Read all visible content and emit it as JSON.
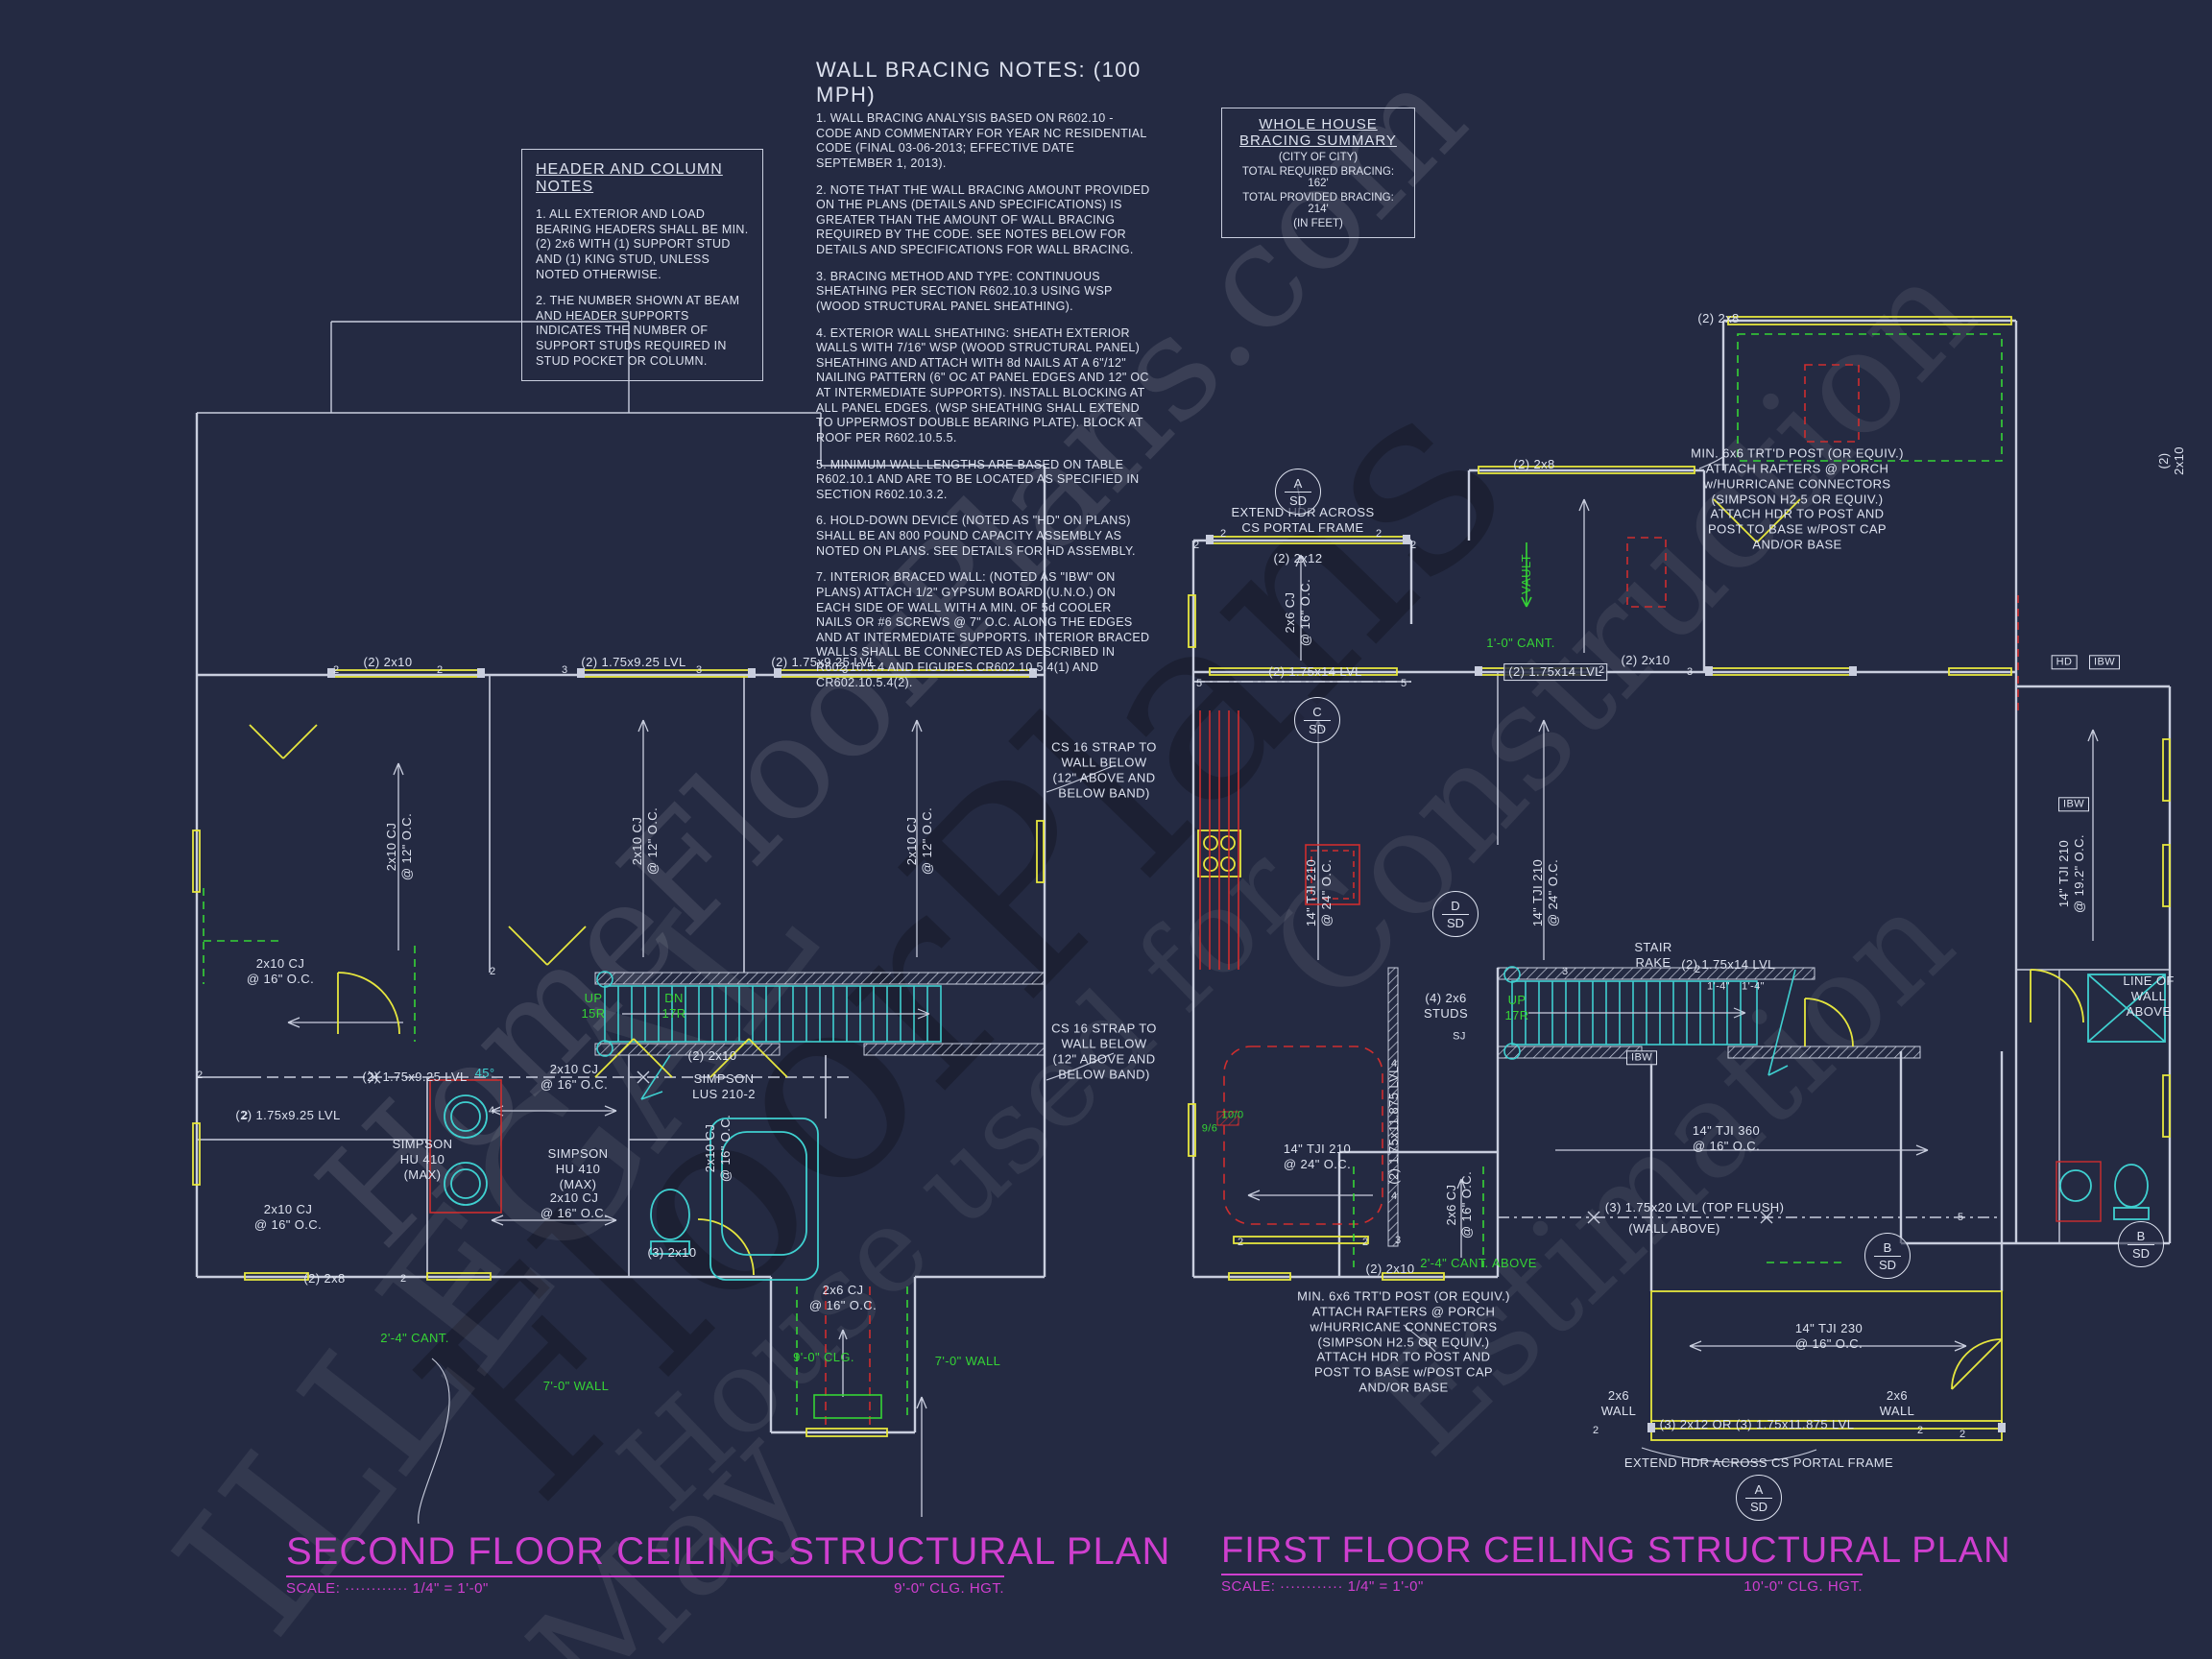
{
  "sheet": {
    "background": "#242a42"
  },
  "colors": {
    "line": "#c9cede",
    "yellow": "#e6e63e",
    "cyan": "#3fd0d0",
    "red": "#cf2e2e",
    "green": "#35d435",
    "magenta": "#cf3fcf",
    "text": "#dde2ef"
  },
  "watermark": {
    "pieces": [
      "ILLEGAL",
      "HomeFloorPlans.com",
      "May",
      "House used for",
      "Construction",
      "Estimation",
      "FloorPlans"
    ]
  },
  "notes": {
    "header_column": {
      "title": "HEADER AND COLUMN NOTES",
      "items": [
        "1. ALL EXTERIOR AND LOAD BEARING HEADERS SHALL BE MIN. (2) 2x6 WITH (1) SUPPORT STUD AND (1) KING STUD, UNLESS NOTED OTHERWISE.",
        "2. THE NUMBER SHOWN AT BEAM AND HEADER SUPPORTS INDICATES THE NUMBER OF SUPPORT STUDS REQUIRED IN STUD POCKET OR COLUMN."
      ]
    },
    "wall_bracing": {
      "title": "WALL BRACING NOTES: (100 MPH)",
      "items": [
        "1. WALL BRACING ANALYSIS BASED ON R602.10 - CODE AND COMMENTARY FOR YEAR NC RESIDENTIAL CODE (FINAL 03-06-2013; EFFECTIVE DATE SEPTEMBER 1, 2013).",
        "2. NOTE THAT THE WALL BRACING AMOUNT PROVIDED ON THE PLANS (DETAILS AND SPECIFICATIONS) IS GREATER THAN THE AMOUNT OF WALL BRACING REQUIRED BY THE CODE. SEE NOTES BELOW FOR DETAILS AND SPECIFICATIONS FOR WALL BRACING.",
        "3. BRACING METHOD AND TYPE: CONTINUOUS SHEATHING PER SECTION R602.10.3 USING WSP (WOOD STRUCTURAL PANEL SHEATHING).",
        "4. EXTERIOR WALL SHEATHING: SHEATH EXTERIOR WALLS WITH 7/16\" WSP (WOOD STRUCTURAL PANEL) SHEATHING AND ATTACH WITH 8d NAILS AT A 6\"/12\" NAILING PATTERN (6\" OC AT PANEL EDGES AND 12\" OC AT INTERMEDIATE SUPPORTS). INSTALL BLOCKING AT ALL PANEL EDGES. (WSP SHEATHING SHALL EXTEND TO UPPERMOST DOUBLE BEARING PLATE). BLOCK AT ROOF PER R602.10.5.5.",
        "5. MINIMUM WALL LENGTHS ARE BASED ON TABLE R602.10.1 AND ARE TO BE LOCATED AS SPECIFIED IN SECTION R602.10.3.2.",
        "6. HOLD-DOWN DEVICE (NOTED AS \"HD\" ON PLANS) SHALL BE AN 800 POUND CAPACITY ASSEMBLY AS NOTED ON PLANS. SEE DETAILS FOR HD ASSEMBLY.",
        "7. INTERIOR BRACED WALL: (NOTED AS \"IBW\" ON PLANS) ATTACH 1/2\" GYPSUM BOARD (U.N.O.) ON EACH SIDE OF WALL WITH A MIN. OF 5d COOLER NAILS OR #6 SCREWS @ 7\" O.C. ALONG THE EDGES AND AT INTERMEDIATE SUPPORTS.  INTERIOR BRACED WALLS SHALL BE CONNECTED AS DESCRIBED IN R602.10.5.4 AND FIGURES CR602.10.5.4(1) AND CR602.10.5.4(2)."
      ]
    },
    "bracing_summary": {
      "title_line1": "WHOLE HOUSE",
      "title_line2": "BRACING SUMMARY",
      "subtitle": "(CITY OF CITY)",
      "required": "TOTAL REQUIRED BRACING: 162'",
      "provided": "TOTAL PROVIDED BRACING: 214'",
      "unit_note": "(IN FEET)"
    }
  },
  "plans": {
    "second": {
      "title": "SECOND FLOOR CEILING STRUCTURAL PLAN",
      "scale": "SCALE: ············ 1/4\" = 1'-0\"",
      "ceiling": "9'-0\" CLG. HGT.",
      "labels": [
        "(2) 2x10",
        "(2) 1.75x9.25 LVL",
        "(2) 1.75x9.25 LVL",
        "2x10 CJ\n@ 12\" O.C.",
        "2x10 CJ\n@ 12\" O.C.",
        "2x10 CJ\n@ 12\" O.C.",
        "CS 16 STRAP TO\nWALL BELOW\n(12\" ABOVE AND\nBELOW BAND)",
        "CS 16 STRAP TO\nWALL BELOW\n(12\" ABOVE AND\nBELOW BAND)",
        "UP\n15R",
        "DN\n17R",
        "45°",
        "(2) 1.75x9.25 LVL",
        "(2) 1.75x9.25 LVL",
        "(2) 2x10",
        "SIMPSON\nLUS 210-2",
        "SIMPSON\nHU 410\n(MAX)",
        "SIMPSON\nHU 410\n(MAX)",
        "2x10 CJ\n@ 16\" O.C.",
        "2x10 CJ\n@ 16\" O.C.",
        "2x10 CJ\n@ 16\" O.C.",
        "2x10 CJ\n@ 16\" O.C.",
        "2x10 CJ\n@ 16\" O.C.",
        "(2) 2x8",
        "(3) 2x10",
        "2'-4\" CANT.",
        "7'-0\" WALL",
        "7'-0\" WALL",
        "9'-0\" CLG.",
        "2x6 CJ\n@ 16\" O.C."
      ],
      "markers": [
        "2",
        "2",
        "3",
        "3",
        "3",
        "2",
        "4",
        "2",
        "2",
        "2"
      ]
    },
    "first": {
      "title": "FIRST FLOOR CEILING STRUCTURAL PLAN",
      "scale": "SCALE: ············ 1/4\" = 1'-0\"",
      "ceiling": "10'-0\" CLG. HGT.",
      "labels": [
        "EXTEND HDR ACROSS\nCS PORTAL FRAME",
        "(2) 2x12",
        "2x6 CJ\n@ 16\" O.C.",
        "(2) 1.75x14 LVL",
        "(2) 2x8",
        "(2) 2x8",
        "VAULT",
        "1'-0\" CANT.",
        "(2) 1.75x14 LVL",
        "(2) 2x10",
        "MIN. 6x6 TRT'D POST (OR EQUIV.)\nATTACH RAFTERS @ PORCH\nw/HURRICANE CONNECTORS\n(SIMPSON H2.5 OR EQUIV.)\nATTACH HDR TO POST AND\nPOST TO BASE w/POST CAP\nAND/OR BASE",
        "14\" TJI 210\n@ 24\" O.C.",
        "14\" TJI 210\n@ 24\" O.C.",
        "(4) 2x6\nSTUDS",
        "UP\n17R",
        "STAIR\nRAKE",
        "IBW",
        "(2) 1.75x14 LVL",
        "1'-4\"",
        "1'-4\"",
        "14\" TJI 360\n@ 16\" O.C.",
        "(3) 1.75x20 LVL (TOP FLUSH)",
        "(WALL ABOVE)",
        "14\" TJI 230\n@ 16\" O.C.",
        "2x6\nWALL",
        "2x6\nWALL",
        "(3) 2x12 OR (3) 1.75x11.875 LVL",
        "EXTEND HDR ACROSS CS PORTAL FRAME",
        "MIN. 6x6 TRT'D POST (OR EQUIV.)\nATTACH RAFTERS @ PORCH\nw/HURRICANE CONNECTORS\n(SIMPSON H2.5 OR EQUIV.)\nATTACH HDR TO POST AND\nPOST TO BASE w/POST CAP\nAND/OR BASE",
        "(2) 2x10",
        "2x6 CJ\n@ 16\" O.C.",
        "2'-4\" CANT. ABOVE",
        "14\" TJI 210\n@ 24\" O.C.",
        "10/0",
        "9/6",
        "(2) 1.75x11.875 LVL",
        "LINE OF\nWALL\nABOVE",
        "14\" TJI 210\n@ 19.2\" O.C.",
        "SJ",
        "HD",
        "IBW",
        "IBW",
        "(2) 2x10"
      ],
      "markers": [
        "2",
        "2",
        "2",
        "2",
        "5",
        "5",
        "2",
        "3",
        "3",
        "2",
        "4",
        "4",
        "3",
        "2",
        "2",
        "5",
        "2",
        "2",
        "2"
      ],
      "callouts": [
        {
          "top": "A",
          "bottom": "SD"
        },
        {
          "top": "C",
          "bottom": "SD"
        },
        {
          "top": "D",
          "bottom": "SD"
        },
        {
          "top": "B",
          "bottom": "SD"
        },
        {
          "top": "B",
          "bottom": "SD"
        },
        {
          "top": "A",
          "bottom": "SD"
        }
      ]
    }
  }
}
